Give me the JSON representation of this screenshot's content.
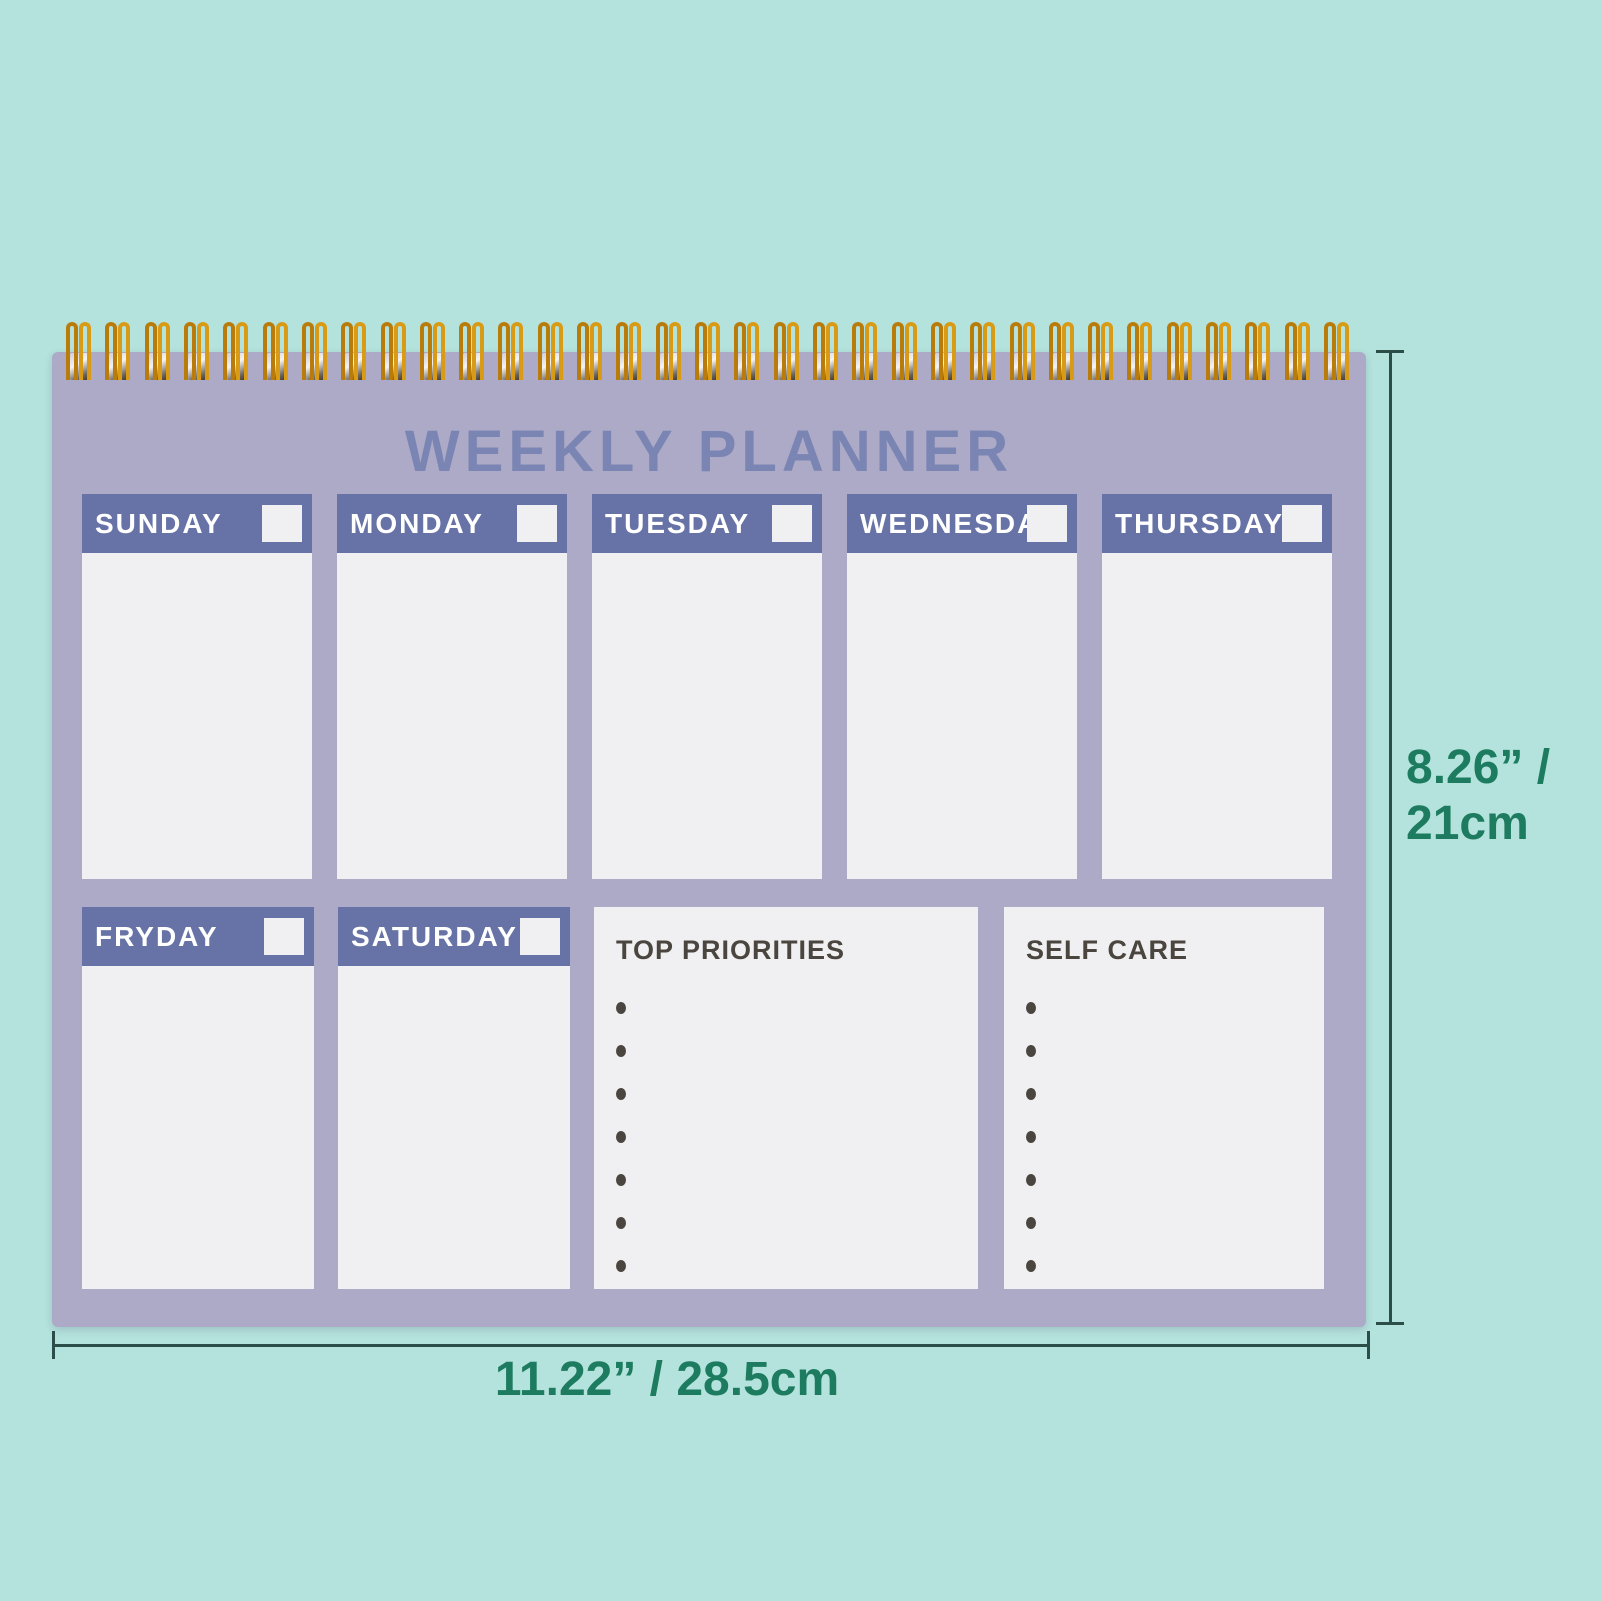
{
  "product": {
    "title": "WEEKLY PLANNER",
    "days_row1": [
      "SUNDAY",
      "MONDAY",
      "TUESDAY",
      "WEDNESDAY",
      "THURSDAY"
    ],
    "days_row2": [
      "FRYDAY",
      "SATURDAY"
    ],
    "sections": [
      {
        "title": "TOP PRIORITIES",
        "bullets": 7
      },
      {
        "title": "SELF CARE",
        "bullets": 7
      }
    ],
    "spiral_loops": 33
  },
  "annotations": {
    "height_label_line1": "8.26” /",
    "height_label_line2": "21cm",
    "width_label": "11.22” / 28.5cm"
  },
  "colors": {
    "teal_background": "#b4e2dd",
    "planner_lavender": "#acaac6",
    "header_blue": "#6773a6",
    "title_blue": "#7b85b4",
    "paper_white": "#f0eff2",
    "ink_dark": "#4a463f",
    "dimension_green": "#1d7b60",
    "dimension_line": "#2b4e49",
    "spiral_gold_dark": "#b97c0a",
    "spiral_gold_light": "#d99b16"
  }
}
